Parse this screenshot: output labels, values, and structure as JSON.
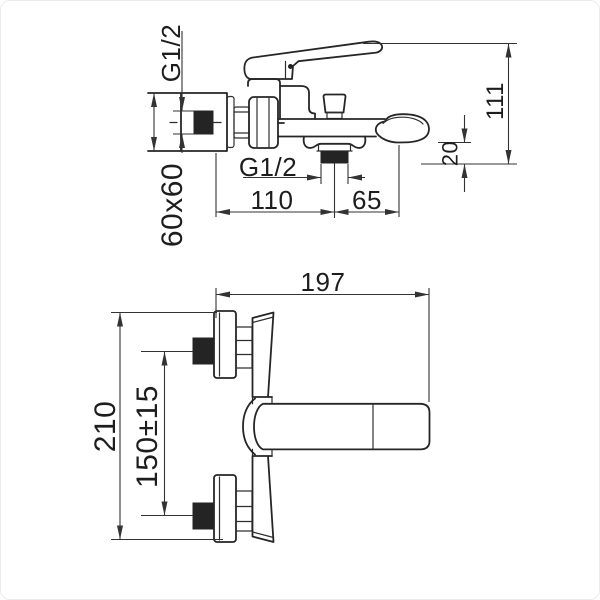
{
  "drawing": {
    "background_color": "#ffffff",
    "line_color": "#262626",
    "fill_color": "#242424",
    "side_view": {
      "dims": {
        "wall_thread": "G1/2",
        "plate_size": "60x60",
        "outlet_thread": "G1/2",
        "plate_to_outlet": "110",
        "outlet_to_aerator": "65",
        "total_height": "111",
        "spout_clearance": "20"
      }
    },
    "front_view": {
      "dims": {
        "total_width": "197",
        "total_height": "210",
        "centers_distance": "150±15"
      }
    }
  }
}
